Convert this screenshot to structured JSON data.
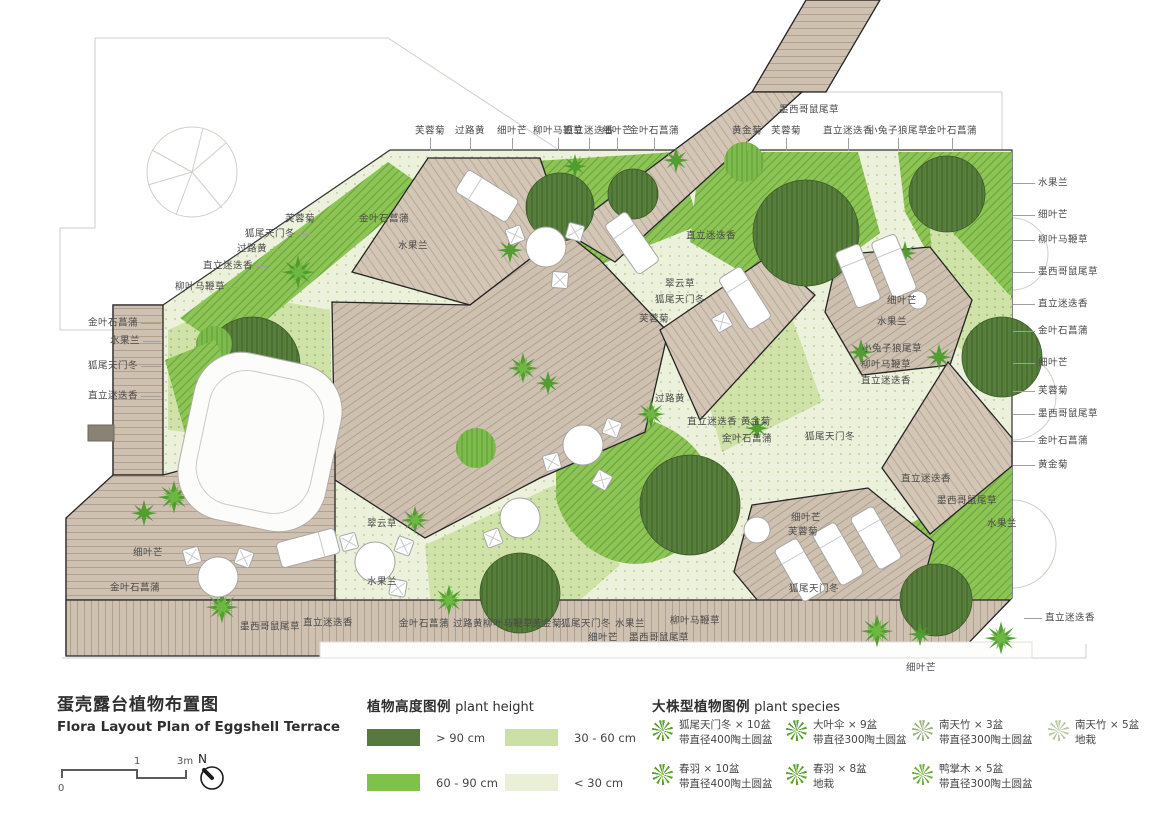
{
  "title": {
    "zh": "蛋壳露台植物布置图",
    "en": "Flora Layout Plan of Eggshell Terrace"
  },
  "scale_bar": {
    "zero": "0",
    "one": "1",
    "three": "3m",
    "north": "N"
  },
  "height_legend": {
    "title_zh": "植物高度图例",
    "title_en": "plant height",
    "items": [
      {
        "label": "> 90 cm",
        "color": "#57793f"
      },
      {
        "label": "30 - 60 cm",
        "color": "#cbe0a4"
      },
      {
        "label": "60 - 90 cm",
        "color": "#7fc24a"
      },
      {
        "label": "< 30 cm",
        "color": "#eaf0d8"
      }
    ]
  },
  "species_legend": {
    "title_zh": "大株型植物图例",
    "title_en": "plant species",
    "items": [
      {
        "name": "狐尾天门冬 × 10盆",
        "note": "带直径400陶土圆盆",
        "icon_color": "#57a02c"
      },
      {
        "name": "大叶伞 × 9盆",
        "note": "带直径300陶土圆盆",
        "icon_color": "#57a02c"
      },
      {
        "name": "南天竹 × 3盆",
        "note": "带直径300陶土圆盆",
        "icon_color": "#9ab37e"
      },
      {
        "name": "南天竹 × 5盆",
        "note": "地栽",
        "icon_color": "#b8c6a2"
      },
      {
        "name": "春羽 × 10盆",
        "note": "带直径400陶土圆盆",
        "icon_color": "#57a02c"
      },
      {
        "name": "春羽 × 8盆",
        "note": "地栽",
        "icon_color": "#57a02c"
      },
      {
        "name": "鸭掌木 × 5盆",
        "note": "带直径300陶土圆盆",
        "icon_color": "#6fae3e"
      }
    ]
  },
  "plan_labels": {
    "items": [
      {
        "t": "芙蓉菊",
        "x": 430,
        "y": 131,
        "a": "m",
        "ld": "down",
        "len": 13
      },
      {
        "t": "过路黄",
        "x": 470,
        "y": 131,
        "a": "m",
        "ld": "down",
        "len": 13
      },
      {
        "t": "细叶芒",
        "x": 512,
        "y": 131,
        "a": "m",
        "ld": "down",
        "len": 13
      },
      {
        "t": "柳叶马鞭草",
        "x": 558,
        "y": 131,
        "a": "m",
        "ld": "down",
        "len": 13
      },
      {
        "t": "直立迷迭香",
        "x": 589,
        "y": 131,
        "a": "m",
        "ld": "down",
        "len": 13
      },
      {
        "t": "细叶芒",
        "x": 617,
        "y": 131,
        "a": "m",
        "ld": "down",
        "len": 13
      },
      {
        "t": "金叶石菖蒲",
        "x": 654,
        "y": 131,
        "a": "m",
        "ld": "down",
        "len": 13
      },
      {
        "t": "黄金菊",
        "x": 747,
        "y": 131,
        "a": "m",
        "ld": "down",
        "len": 13
      },
      {
        "t": "芙蓉菊",
        "x": 786,
        "y": 131,
        "a": "m",
        "ld": "down",
        "len": 13
      },
      {
        "t": "墨西哥鼠尾草",
        "x": 809,
        "y": 110,
        "a": "m"
      },
      {
        "t": "直立迷迭香",
        "x": 848,
        "y": 131,
        "a": "m",
        "ld": "down",
        "len": 13
      },
      {
        "t": "小兔子狼尾草",
        "x": 898,
        "y": 131,
        "a": "m",
        "ld": "down",
        "len": 13
      },
      {
        "t": "金叶石菖蒲",
        "x": 952,
        "y": 131,
        "a": "m",
        "ld": "down",
        "len": 13
      },
      {
        "t": "芙蓉菊",
        "x": 315,
        "y": 219,
        "a": "e",
        "ld": "right",
        "len": 12
      },
      {
        "t": "狐尾天门冬",
        "x": 295,
        "y": 234,
        "a": "e",
        "ld": "right",
        "len": 12
      },
      {
        "t": "过路黄",
        "x": 267,
        "y": 249,
        "a": "e",
        "ld": "right",
        "len": 12
      },
      {
        "t": "直立迷迭香",
        "x": 253,
        "y": 266,
        "a": "e",
        "ld": "right",
        "len": 12
      },
      {
        "t": "柳叶马鞭草",
        "x": 225,
        "y": 287,
        "a": "e",
        "ld": "right",
        "len": 12
      },
      {
        "t": "金叶石菖蒲",
        "x": 138,
        "y": 323,
        "a": "e",
        "ld": "right",
        "len": 20
      },
      {
        "t": "水果兰",
        "x": 140,
        "y": 341,
        "a": "e",
        "ld": "right",
        "len": 18
      },
      {
        "t": "狐尾天门冬",
        "x": 138,
        "y": 366,
        "a": "e",
        "ld": "right",
        "len": 20
      },
      {
        "t": "直立迷迭香",
        "x": 138,
        "y": 396,
        "a": "e",
        "ld": "right",
        "len": 20
      },
      {
        "t": "细叶芒",
        "x": 163,
        "y": 553,
        "a": "e"
      },
      {
        "t": "金叶石菖蒲",
        "x": 160,
        "y": 588,
        "a": "e"
      },
      {
        "t": "水果兰",
        "x": 1038,
        "y": 183,
        "a": "s",
        "ld": "left",
        "len": 22
      },
      {
        "t": "细叶芒",
        "x": 1038,
        "y": 215,
        "a": "s",
        "ld": "left",
        "len": 22
      },
      {
        "t": "柳叶马鞭草",
        "x": 1038,
        "y": 240,
        "a": "s",
        "ld": "left",
        "len": 22
      },
      {
        "t": "墨西哥鼠尾草",
        "x": 1038,
        "y": 272,
        "a": "s",
        "ld": "left",
        "len": 22
      },
      {
        "t": "直立迷迭香",
        "x": 1038,
        "y": 304,
        "a": "s",
        "ld": "left",
        "len": 22
      },
      {
        "t": "金叶石菖蒲",
        "x": 1038,
        "y": 331,
        "a": "s",
        "ld": "left",
        "len": 22
      },
      {
        "t": "细叶芒",
        "x": 1038,
        "y": 363,
        "a": "s",
        "ld": "left",
        "len": 22
      },
      {
        "t": "芙蓉菊",
        "x": 1038,
        "y": 391,
        "a": "s",
        "ld": "left",
        "len": 22
      },
      {
        "t": "墨西哥鼠尾草",
        "x": 1038,
        "y": 414,
        "a": "s",
        "ld": "left",
        "len": 22
      },
      {
        "t": "金叶石菖蒲",
        "x": 1038,
        "y": 441,
        "a": "s",
        "ld": "left",
        "len": 22
      },
      {
        "t": "黄金菊",
        "x": 1038,
        "y": 465,
        "a": "s",
        "ld": "left",
        "len": 22
      },
      {
        "t": "直立迷迭香",
        "x": 1045,
        "y": 618,
        "a": "s",
        "ld": "left",
        "len": 18
      },
      {
        "t": "墨西哥鼠尾草",
        "x": 270,
        "y": 627,
        "a": "m"
      },
      {
        "t": "直立迷迭香",
        "x": 328,
        "y": 623,
        "a": "m"
      },
      {
        "t": "金叶石菖蒲",
        "x": 424,
        "y": 624,
        "a": "m"
      },
      {
        "t": "过路黄",
        "x": 468,
        "y": 624,
        "a": "m"
      },
      {
        "t": "柳叶马鞭草",
        "x": 508,
        "y": 624,
        "a": "m"
      },
      {
        "t": "黄金菊",
        "x": 547,
        "y": 624,
        "a": "m"
      },
      {
        "t": "狐尾天门冬",
        "x": 586,
        "y": 624,
        "a": "m"
      },
      {
        "t": "水果兰",
        "x": 630,
        "y": 624,
        "a": "m"
      },
      {
        "t": "柳叶马鞭草",
        "x": 695,
        "y": 621,
        "a": "m"
      },
      {
        "t": "细叶芒",
        "x": 603,
        "y": 638,
        "a": "m"
      },
      {
        "t": "墨西哥鼠尾草",
        "x": 659,
        "y": 638,
        "a": "m"
      },
      {
        "t": "细叶芒",
        "x": 921,
        "y": 668,
        "a": "m"
      },
      {
        "t": "金叶石菖蒲",
        "x": 384,
        "y": 219,
        "a": "m"
      },
      {
        "t": "水果兰",
        "x": 413,
        "y": 246,
        "a": "m"
      },
      {
        "t": "直立迷迭香",
        "x": 711,
        "y": 236,
        "a": "m"
      },
      {
        "t": "翠云草",
        "x": 680,
        "y": 284,
        "a": "m"
      },
      {
        "t": "狐尾天门冬",
        "x": 680,
        "y": 300,
        "a": "m"
      },
      {
        "t": "芙蓉菊",
        "x": 654,
        "y": 319,
        "a": "m"
      },
      {
        "t": "细叶芒",
        "x": 902,
        "y": 301,
        "a": "m"
      },
      {
        "t": "水果兰",
        "x": 892,
        "y": 322,
        "a": "m"
      },
      {
        "t": "小兔子狼尾草",
        "x": 892,
        "y": 349,
        "a": "m"
      },
      {
        "t": "柳叶马鞭草",
        "x": 886,
        "y": 365,
        "a": "m"
      },
      {
        "t": "直立迷迭香",
        "x": 886,
        "y": 381,
        "a": "m"
      },
      {
        "t": "过路黄",
        "x": 670,
        "y": 399,
        "a": "m"
      },
      {
        "t": "直立迷迭香 黄金菊",
        "x": 729,
        "y": 422,
        "a": "m"
      },
      {
        "t": "金叶石菖蒲",
        "x": 747,
        "y": 439,
        "a": "m"
      },
      {
        "t": "狐尾天门冬",
        "x": 830,
        "y": 437,
        "a": "m"
      },
      {
        "t": "直立迷迭香",
        "x": 926,
        "y": 479,
        "a": "m"
      },
      {
        "t": "墨西哥鼠尾草",
        "x": 967,
        "y": 501,
        "a": "m"
      },
      {
        "t": "水果兰",
        "x": 1002,
        "y": 524,
        "a": "m"
      },
      {
        "t": "翠云草",
        "x": 382,
        "y": 524,
        "a": "m"
      },
      {
        "t": "水果兰",
        "x": 382,
        "y": 582,
        "a": "m"
      },
      {
        "t": "细叶芒",
        "x": 806,
        "y": 518,
        "a": "m"
      },
      {
        "t": "芙蓉菊",
        "x": 803,
        "y": 532,
        "a": "m"
      },
      {
        "t": "狐尾天门冬",
        "x": 814,
        "y": 589,
        "a": "m"
      }
    ]
  }
}
